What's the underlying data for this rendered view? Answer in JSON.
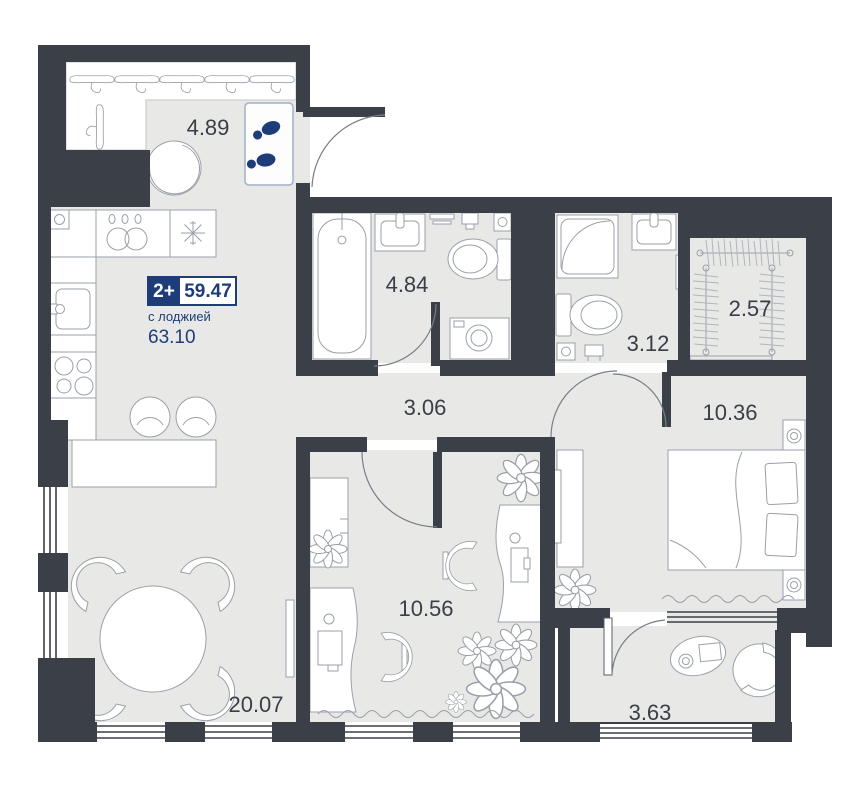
{
  "badge": {
    "rooms_count": "2+",
    "area_total": "59.47",
    "loggia_note": "с лоджией",
    "area_with_loggia": "63.10"
  },
  "rooms": [
    {
      "id": "hallway",
      "area": "4.89"
    },
    {
      "id": "bathroom",
      "area": "4.84"
    },
    {
      "id": "hall",
      "area": "3.06"
    },
    {
      "id": "wc",
      "area": "3.12"
    },
    {
      "id": "wardrobe",
      "area": "2.57"
    },
    {
      "id": "bedroom",
      "area": "10.36"
    },
    {
      "id": "office",
      "area": "10.56"
    },
    {
      "id": "living-kitchen",
      "area": "20.07"
    },
    {
      "id": "loggia",
      "area": "3.63"
    }
  ],
  "colors": {
    "wall": "#3b3f47",
    "floor": "#e8e9e7",
    "accent": "#1e3c78",
    "furniture_line": "#9aa0a8"
  }
}
